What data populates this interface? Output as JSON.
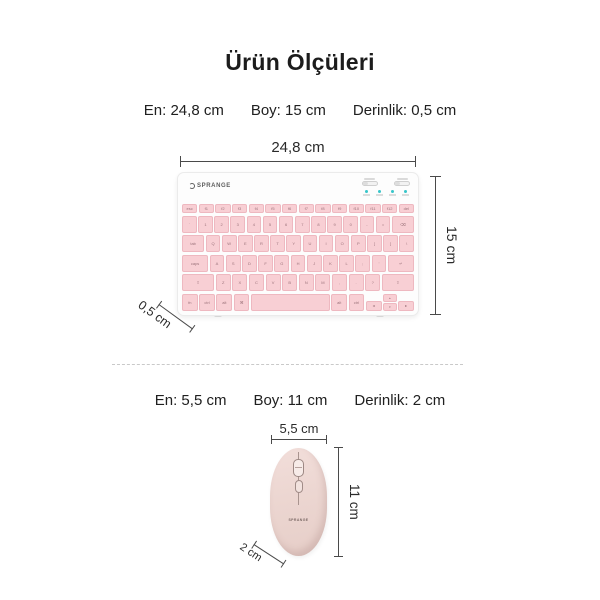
{
  "title": "Ürün Ölçüleri",
  "keyboard_section": {
    "specs": {
      "width": "En: 24,8 cm",
      "height": "Boy: 15 cm",
      "depth": "Derinlik: 0,5 cm"
    },
    "dim_width": "24,8 cm",
    "dim_height": "15 cm",
    "dim_depth": "0,5 cm",
    "brand": "SPRANGE",
    "key_rows": [
      {
        "small": true,
        "keys": [
          {
            "l": "esc"
          },
          {
            "l": "f1"
          },
          {
            "l": "f2"
          },
          {
            "l": "f3"
          },
          {
            "l": "f4"
          },
          {
            "l": "f5"
          },
          {
            "l": "f6"
          },
          {
            "l": "f7"
          },
          {
            "l": "f8"
          },
          {
            "l": "f9"
          },
          {
            "l": "f10"
          },
          {
            "l": "f11"
          },
          {
            "l": "f12"
          },
          {
            "l": "del"
          }
        ]
      },
      {
        "keys": [
          {
            "l": "`"
          },
          {
            "l": "1"
          },
          {
            "l": "2"
          },
          {
            "l": "3"
          },
          {
            "l": "4"
          },
          {
            "l": "5"
          },
          {
            "l": "6"
          },
          {
            "l": "7"
          },
          {
            "l": "8"
          },
          {
            "l": "9"
          },
          {
            "l": "0"
          },
          {
            "l": "-"
          },
          {
            "l": "="
          },
          {
            "l": "⌫",
            "w": 1.6
          }
        ]
      },
      {
        "keys": [
          {
            "l": "tab",
            "w": 1.6
          },
          {
            "l": "Q"
          },
          {
            "l": "W"
          },
          {
            "l": "E"
          },
          {
            "l": "R"
          },
          {
            "l": "T"
          },
          {
            "l": "Y"
          },
          {
            "l": "U"
          },
          {
            "l": "I"
          },
          {
            "l": "O"
          },
          {
            "l": "P"
          },
          {
            "l": "["
          },
          {
            "l": "]"
          },
          {
            "l": "\\"
          }
        ]
      },
      {
        "keys": [
          {
            "l": "caps",
            "w": 1.9
          },
          {
            "l": "A"
          },
          {
            "l": "S"
          },
          {
            "l": "D"
          },
          {
            "l": "F"
          },
          {
            "l": "G"
          },
          {
            "l": "H"
          },
          {
            "l": "J"
          },
          {
            "l": "K"
          },
          {
            "l": "L"
          },
          {
            "l": ";"
          },
          {
            "l": "'"
          },
          {
            "l": "↵",
            "w": 1.9
          }
        ]
      },
      {
        "keys": [
          {
            "l": "⇧",
            "w": 2.3
          },
          {
            "l": "Z"
          },
          {
            "l": "X"
          },
          {
            "l": "C"
          },
          {
            "l": "V"
          },
          {
            "l": "B"
          },
          {
            "l": "N"
          },
          {
            "l": "M"
          },
          {
            "l": ","
          },
          {
            "l": "."
          },
          {
            "l": "?"
          },
          {
            "l": "⇧",
            "w": 2.3
          }
        ]
      },
      {
        "keys": [
          {
            "l": "fn"
          },
          {
            "l": "ctrl"
          },
          {
            "l": "alt"
          },
          {
            "l": "⌘"
          },
          {
            "l": "",
            "w": 5.6
          },
          {
            "l": "alt"
          },
          {
            "l": "ctrl"
          },
          {
            "l": "◂",
            "half": true
          },
          {
            "ud": [
              "▴",
              "▾"
            ]
          },
          {
            "l": "▸",
            "half": true
          }
        ]
      }
    ]
  },
  "mouse_section": {
    "specs": {
      "width": "En: 5,5 cm",
      "height": "Boy: 11 cm",
      "depth": "Derinlik: 2 cm"
    },
    "dim_width": "5,5 cm",
    "dim_height": "11 cm",
    "dim_depth": "2 cm",
    "brand": "SPRANGE"
  },
  "colors": {
    "dim_line": "#4a4a4a",
    "key_fill": "#f8cfd4",
    "key_border": "#eeb8c0",
    "key_text": "#9c737b",
    "mouse_fill": "#ecd6d1",
    "led_teal": "#38c6ca"
  }
}
